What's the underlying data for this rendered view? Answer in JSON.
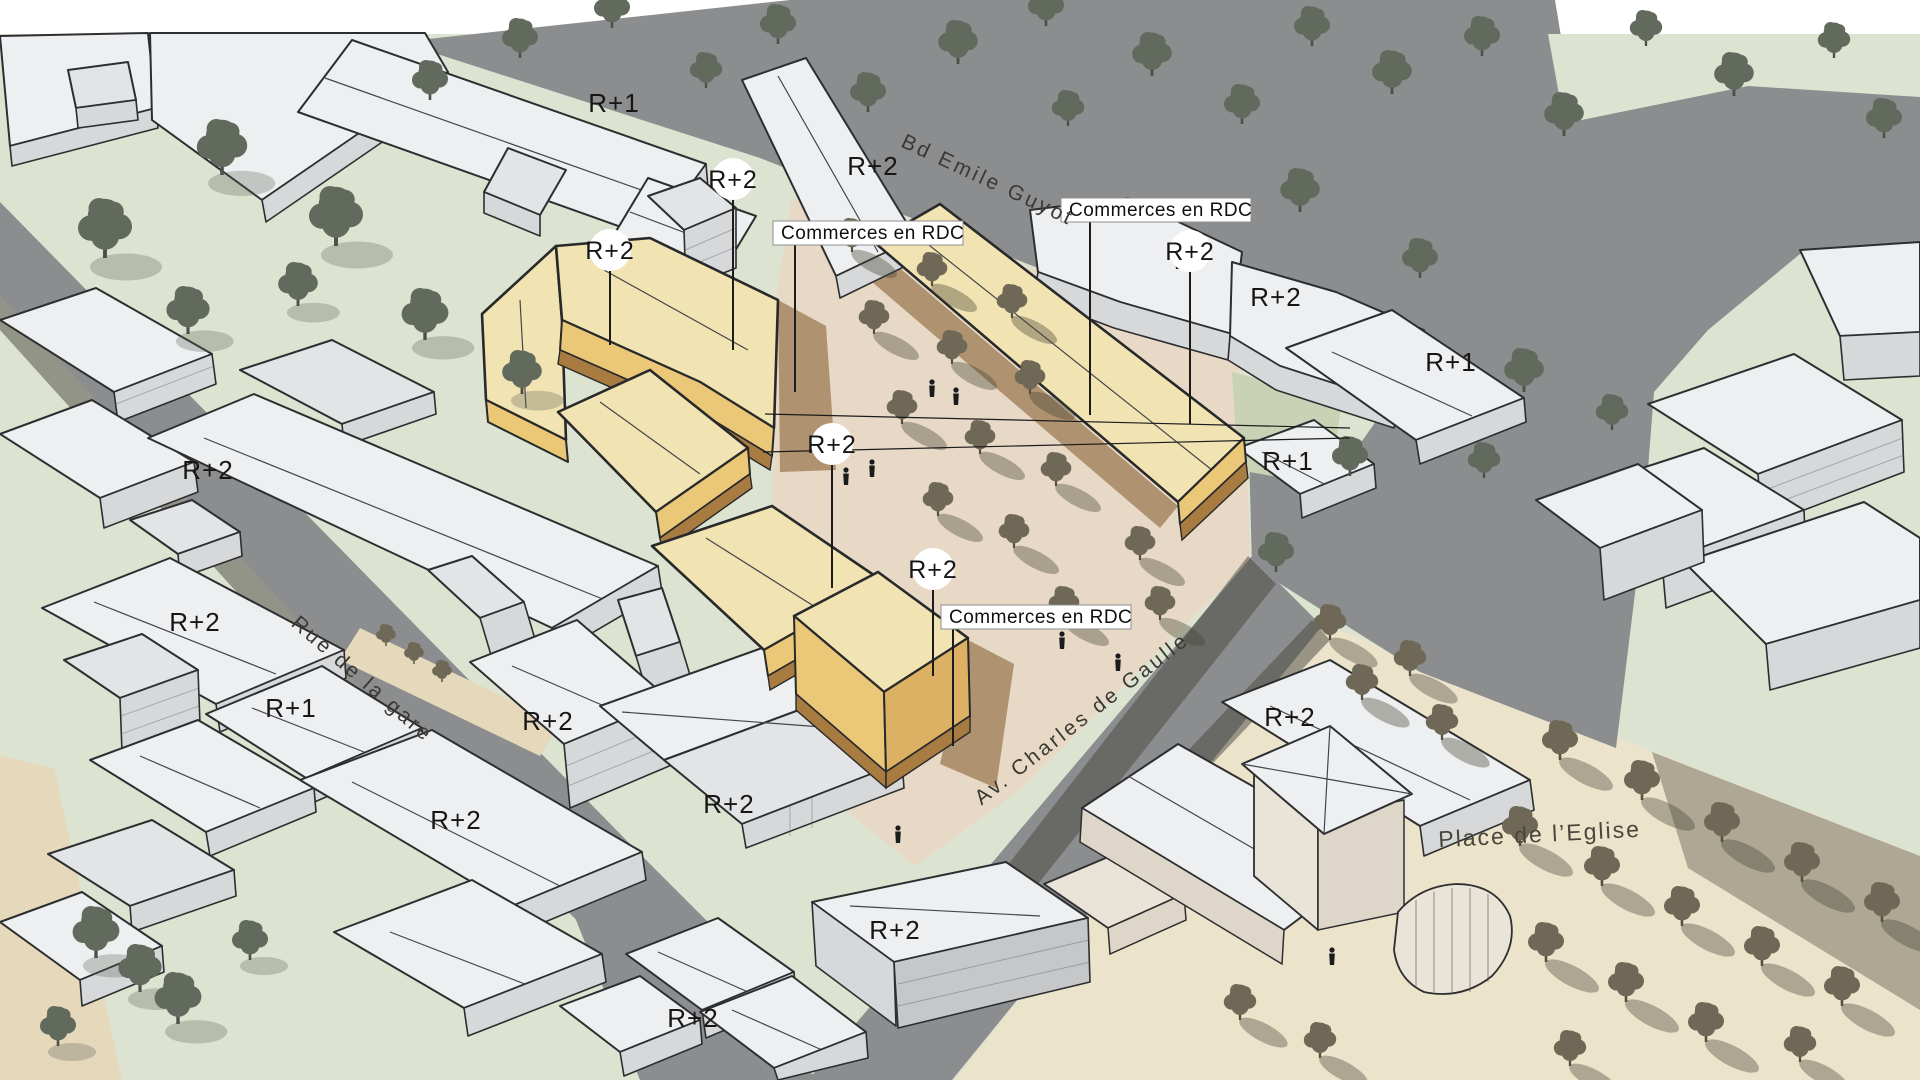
{
  "colors": {
    "background": "#ffffff",
    "lawn": "#dde3d1",
    "road": "#8b8d8f",
    "central_plaza": "#e7d9c5",
    "church_square": "#ece3cb",
    "existing_building_roof": "#edeff0",
    "existing_building_wall": "#d6d8da",
    "project_building_roof": "#f1e3b2",
    "project_building_wall": "#ebc878",
    "project_building_base": "#a87b41",
    "outline": "#2d2e30",
    "tree_lawn": "#626a5e",
    "tree_plaza": "#6f6857",
    "label_text": "#161616"
  },
  "annotations": {
    "floor_labels": [
      {
        "text": "R+1",
        "x": 614,
        "y": 112
      },
      {
        "text": "R+2",
        "x": 873,
        "y": 175
      },
      {
        "text": "R+2",
        "x": 1276,
        "y": 306
      },
      {
        "text": "R+1",
        "x": 1451,
        "y": 371
      },
      {
        "text": "R+1",
        "x": 1288,
        "y": 470
      },
      {
        "text": "R+2",
        "x": 208,
        "y": 479
      },
      {
        "text": "R+2",
        "x": 195,
        "y": 631
      },
      {
        "text": "R+1",
        "x": 291,
        "y": 717
      },
      {
        "text": "R+2",
        "x": 548,
        "y": 730
      },
      {
        "text": "R+2",
        "x": 1290,
        "y": 726
      },
      {
        "text": "R+2",
        "x": 456,
        "y": 829
      },
      {
        "text": "R+2",
        "x": 729,
        "y": 813
      },
      {
        "text": "R+2",
        "x": 895,
        "y": 939
      },
      {
        "text": "R+2",
        "x": 693,
        "y": 1027
      }
    ],
    "circled_labels": [
      {
        "text": "R+2",
        "cx": 733,
        "cy": 179
      },
      {
        "text": "R+2",
        "cx": 610,
        "cy": 250
      },
      {
        "text": "R+2",
        "cx": 832,
        "cy": 444
      },
      {
        "text": "R+2",
        "cx": 933,
        "cy": 569
      },
      {
        "text": "R+2",
        "cx": 1190,
        "cy": 251
      }
    ],
    "callouts": [
      {
        "text": "Commerces en RDC",
        "x": 773,
        "y": 221
      },
      {
        "text": "Commerces en RDC",
        "x": 1061,
        "y": 198
      },
      {
        "text": "Commerces en RDC",
        "x": 941,
        "y": 605
      }
    ],
    "streets": [
      {
        "text": "Bd Emile Guyot",
        "x": 985,
        "y": 186,
        "angle": 25
      },
      {
        "text": "Rue de la gare",
        "x": 358,
        "y": 684,
        "angle": 41
      },
      {
        "text": "Av. Charles de Gaulle",
        "x": 1086,
        "y": 724,
        "angle": -38
      },
      {
        "text": "Place de l’Eglise",
        "x": 1540,
        "y": 842,
        "angle": -3
      }
    ]
  },
  "scene": {
    "trees": [
      {
        "x": 430,
        "y": 100,
        "t": "g",
        "s": 1.0
      },
      {
        "x": 520,
        "y": 58,
        "t": "g",
        "s": 1.0
      },
      {
        "x": 612,
        "y": 28,
        "t": "g",
        "s": 1.0
      },
      {
        "x": 706,
        "y": 88,
        "t": "g",
        "s": 0.9
      },
      {
        "x": 778,
        "y": 44,
        "t": "g",
        "s": 1.0
      },
      {
        "x": 868,
        "y": 112,
        "t": "g",
        "s": 1.0
      },
      {
        "x": 958,
        "y": 64,
        "t": "g",
        "s": 1.1
      },
      {
        "x": 1046,
        "y": 26,
        "t": "g",
        "s": 1.0
      },
      {
        "x": 1068,
        "y": 126,
        "t": "g",
        "s": 0.9
      },
      {
        "x": 1152,
        "y": 76,
        "t": "g",
        "s": 1.1
      },
      {
        "x": 1242,
        "y": 124,
        "t": "g",
        "s": 1.0
      },
      {
        "x": 1312,
        "y": 46,
        "t": "g",
        "s": 1.0
      },
      {
        "x": 1392,
        "y": 94,
        "t": "g",
        "s": 1.1
      },
      {
        "x": 1482,
        "y": 56,
        "t": "g",
        "s": 1.0
      },
      {
        "x": 1564,
        "y": 136,
        "t": "g",
        "s": 1.1
      },
      {
        "x": 1646,
        "y": 46,
        "t": "g",
        "s": 0.9
      },
      {
        "x": 1734,
        "y": 96,
        "t": "g",
        "s": 1.1
      },
      {
        "x": 1834,
        "y": 58,
        "t": "g",
        "s": 0.9
      },
      {
        "x": 1884,
        "y": 138,
        "t": "g",
        "s": 1.0
      },
      {
        "x": 1300,
        "y": 212,
        "t": "g",
        "s": 1.1
      },
      {
        "x": 1420,
        "y": 278,
        "t": "g",
        "s": 1.0
      },
      {
        "x": 1524,
        "y": 392,
        "t": "g",
        "s": 1.1
      },
      {
        "x": 1350,
        "y": 476,
        "t": "g",
        "s": 1.0
      },
      {
        "x": 1276,
        "y": 572,
        "t": "g",
        "s": 1.0
      },
      {
        "x": 1484,
        "y": 478,
        "t": "g",
        "s": 0.9
      },
      {
        "x": 1612,
        "y": 430,
        "t": "g",
        "s": 0.9
      },
      {
        "x": 105,
        "y": 258,
        "t": "g",
        "s": 1.5,
        "lsh": 1
      },
      {
        "x": 222,
        "y": 175,
        "t": "g",
        "s": 1.4,
        "lsh": 1
      },
      {
        "x": 336,
        "y": 246,
        "t": "g",
        "s": 1.5,
        "lsh": 1
      },
      {
        "x": 188,
        "y": 334,
        "t": "g",
        "s": 1.2,
        "lsh": 1
      },
      {
        "x": 298,
        "y": 306,
        "t": "g",
        "s": 1.1,
        "lsh": 1
      },
      {
        "x": 425,
        "y": 340,
        "t": "g",
        "s": 1.3,
        "lsh": 1
      },
      {
        "x": 522,
        "y": 394,
        "t": "g",
        "s": 1.1,
        "lsh": 1
      },
      {
        "x": 96,
        "y": 958,
        "t": "g",
        "s": 1.3,
        "lsh": 1
      },
      {
        "x": 140,
        "y": 992,
        "t": "g",
        "s": 1.2,
        "lsh": 1
      },
      {
        "x": 178,
        "y": 1024,
        "t": "g",
        "s": 1.3,
        "lsh": 1
      },
      {
        "x": 58,
        "y": 1046,
        "t": "g",
        "s": 1.0,
        "lsh": 1
      },
      {
        "x": 250,
        "y": 960,
        "t": "g",
        "s": 1.0,
        "lsh": 1
      },
      {
        "x": 386,
        "y": 646,
        "t": "o",
        "s": 0.55
      },
      {
        "x": 414,
        "y": 664,
        "t": "o",
        "s": 0.55
      },
      {
        "x": 442,
        "y": 682,
        "t": "o",
        "s": 0.55
      },
      {
        "x": 852,
        "y": 252,
        "t": "o",
        "s": 0.85,
        "sh": 1
      },
      {
        "x": 932,
        "y": 286,
        "t": "o",
        "s": 0.85,
        "sh": 1
      },
      {
        "x": 1012,
        "y": 318,
        "t": "o",
        "s": 0.85,
        "sh": 1
      },
      {
        "x": 874,
        "y": 334,
        "t": "o",
        "s": 0.85,
        "sh": 1
      },
      {
        "x": 952,
        "y": 364,
        "t": "o",
        "s": 0.85,
        "sh": 1
      },
      {
        "x": 1030,
        "y": 394,
        "t": "o",
        "s": 0.85,
        "sh": 1
      },
      {
        "x": 902,
        "y": 424,
        "t": "o",
        "s": 0.85,
        "sh": 1
      },
      {
        "x": 980,
        "y": 454,
        "t": "o",
        "s": 0.85,
        "sh": 1
      },
      {
        "x": 1056,
        "y": 486,
        "t": "o",
        "s": 0.85,
        "sh": 1
      },
      {
        "x": 938,
        "y": 516,
        "t": "o",
        "s": 0.85,
        "sh": 1
      },
      {
        "x": 1014,
        "y": 548,
        "t": "o",
        "s": 0.85,
        "sh": 1
      },
      {
        "x": 1064,
        "y": 620,
        "t": "o",
        "s": 0.85,
        "sh": 1
      },
      {
        "x": 1140,
        "y": 560,
        "t": "o",
        "s": 0.85,
        "sh": 1
      },
      {
        "x": 1160,
        "y": 620,
        "t": "o",
        "s": 0.85,
        "sh": 1
      },
      {
        "x": 1560,
        "y": 760,
        "t": "o",
        "s": 1.0,
        "sh": 1
      },
      {
        "x": 1642,
        "y": 800,
        "t": "o",
        "s": 1.0,
        "sh": 1
      },
      {
        "x": 1722,
        "y": 842,
        "t": "o",
        "s": 1.0,
        "sh": 1
      },
      {
        "x": 1802,
        "y": 882,
        "t": "o",
        "s": 1.0,
        "sh": 1
      },
      {
        "x": 1882,
        "y": 922,
        "t": "o",
        "s": 1.0,
        "sh": 1
      },
      {
        "x": 1520,
        "y": 846,
        "t": "o",
        "s": 1.0,
        "sh": 1
      },
      {
        "x": 1602,
        "y": 886,
        "t": "o",
        "s": 1.0,
        "sh": 1
      },
      {
        "x": 1682,
        "y": 926,
        "t": "o",
        "s": 1.0,
        "sh": 1
      },
      {
        "x": 1762,
        "y": 966,
        "t": "o",
        "s": 1.0,
        "sh": 1
      },
      {
        "x": 1842,
        "y": 1006,
        "t": "o",
        "s": 1.0,
        "sh": 1
      },
      {
        "x": 1546,
        "y": 962,
        "t": "o",
        "s": 1.0,
        "sh": 1
      },
      {
        "x": 1626,
        "y": 1002,
        "t": "o",
        "s": 1.0,
        "sh": 1
      },
      {
        "x": 1706,
        "y": 1042,
        "t": "o",
        "s": 1.0,
        "sh": 1
      },
      {
        "x": 1362,
        "y": 700,
        "t": "o",
        "s": 0.9,
        "sh": 1
      },
      {
        "x": 1442,
        "y": 740,
        "t": "o",
        "s": 0.9,
        "sh": 1
      },
      {
        "x": 1330,
        "y": 640,
        "t": "o",
        "s": 0.9,
        "sh": 1
      },
      {
        "x": 1410,
        "y": 676,
        "t": "o",
        "s": 0.9,
        "sh": 1
      },
      {
        "x": 1240,
        "y": 1020,
        "t": "o",
        "s": 0.9,
        "sh": 1
      },
      {
        "x": 1320,
        "y": 1058,
        "t": "o",
        "s": 0.9,
        "sh": 1
      },
      {
        "x": 1570,
        "y": 1066,
        "t": "o",
        "s": 0.9,
        "sh": 1
      },
      {
        "x": 1800,
        "y": 1062,
        "t": "o",
        "s": 0.9,
        "sh": 1
      }
    ],
    "people": [
      {
        "x": 932,
        "y": 390
      },
      {
        "x": 956,
        "y": 398
      },
      {
        "x": 1062,
        "y": 642
      },
      {
        "x": 1118,
        "y": 664
      },
      {
        "x": 1178,
        "y": 262
      },
      {
        "x": 898,
        "y": 836
      },
      {
        "x": 1332,
        "y": 958
      },
      {
        "x": 872,
        "y": 470
      },
      {
        "x": 846,
        "y": 478
      }
    ],
    "lines": [
      {
        "x1": 733,
        "y1": 200,
        "x2": 733,
        "y2": 350,
        "w": 2
      },
      {
        "x1": 610,
        "y1": 271,
        "x2": 610,
        "y2": 345,
        "w": 2
      },
      {
        "x1": 832,
        "y1": 465,
        "x2": 832,
        "y2": 588,
        "w": 2
      },
      {
        "x1": 933,
        "y1": 590,
        "x2": 933,
        "y2": 676,
        "w": 2
      },
      {
        "x1": 1190,
        "y1": 272,
        "x2": 1190,
        "y2": 424,
        "w": 2
      },
      {
        "x1": 795,
        "y1": 244,
        "x2": 795,
        "y2": 392,
        "w": 2
      },
      {
        "x1": 1090,
        "y1": 222,
        "x2": 1090,
        "y2": 415,
        "w": 2
      },
      {
        "x1": 953,
        "y1": 629,
        "x2": 953,
        "y2": 746,
        "w": 2
      },
      {
        "x1": 765,
        "y1": 414,
        "x2": 1350,
        "y2": 428,
        "w": 1.2
      },
      {
        "x1": 763,
        "y1": 452,
        "x2": 1350,
        "y2": 438,
        "w": 1.2
      }
    ]
  }
}
